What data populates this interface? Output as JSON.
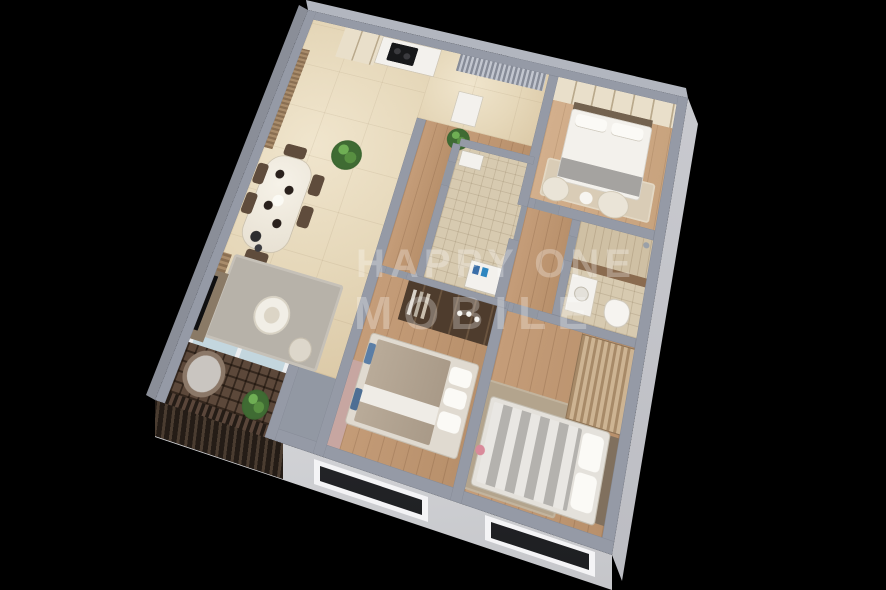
{
  "scene": {
    "type": "3d-isometric-floor-plan-render",
    "background_color": "#000000",
    "subject": "two-plus-bedroom apartment cutaway model"
  },
  "watermark": {
    "line1": "HAPPY ONE",
    "line2": "MOBILE",
    "color": "rgba(255,255,255,0.28)"
  },
  "palette": {
    "wall_top": "#959aa6",
    "exterior_face": "#dfe0e4",
    "marble_floor": "#e8dcc2",
    "wood_floor": "#c49b76",
    "tile_floor": "#d7cab0",
    "balcony_lattice": "#5c483a",
    "plant_green": "#3f6b33",
    "accent_blue": "#5b7ea6",
    "accent_mauve": "#c7a6a1",
    "window_glass": "#26272b"
  },
  "rooms": [
    {
      "name": "kitchen-dining",
      "floor": "marble",
      "furniture": [
        "tall-cabinet",
        "kitchen-counter",
        "cooktop",
        "dining-table",
        "dining-chairs",
        "tall-plant",
        "curtain-wall"
      ]
    },
    {
      "name": "living-room",
      "floor": "marble",
      "furniture": [
        "gray-rug",
        "round-coffee-table",
        "floor-cushion",
        "tv-cabinet",
        "floor-lamp",
        "curtains"
      ]
    },
    {
      "name": "entry-hall",
      "floor": "marble",
      "furniture": [
        "louver-screen",
        "console-table",
        "plant"
      ]
    },
    {
      "name": "master-bedroom",
      "floor": "wood",
      "furniture": [
        "shelving-wall",
        "double-bed",
        "rug",
        "pouf-chairs",
        "side-table"
      ]
    },
    {
      "name": "master-bathroom",
      "floor": "tile",
      "furniture": [
        "shower",
        "vanity-sink",
        "toilet",
        "brown-tile-band"
      ]
    },
    {
      "name": "bathroom-2",
      "floor": "mosaic-tile",
      "furniture": [
        "washing-machine",
        "sink"
      ]
    },
    {
      "name": "corridor",
      "floor": "wood",
      "furniture": []
    },
    {
      "name": "walk-in-wardrobe",
      "floor": "wood",
      "furniture": [
        "dark-shelving",
        "bottles",
        "clothes"
      ]
    },
    {
      "name": "bedroom-2",
      "floor": "wood",
      "furniture": [
        "double-bed",
        "mauve-wardrobe-panel",
        "wall-tv",
        "blue-cushions"
      ]
    },
    {
      "name": "bedroom-3",
      "floor": "wood",
      "furniture": [
        "double-bed-striped",
        "slatted-wardrobe",
        "rug",
        "flowers"
      ]
    },
    {
      "name": "balcony",
      "floor": "lattice-tile",
      "furniture": [
        "papasan-chair",
        "potted-plant",
        "glass-sliding-door",
        "railing"
      ]
    }
  ],
  "exterior": {
    "visible_faces": [
      "south-west",
      "south-east"
    ],
    "windows": [
      "bedroom-2-window",
      "bedroom-3-window"
    ],
    "balcony_railing": "dark-lattice"
  }
}
